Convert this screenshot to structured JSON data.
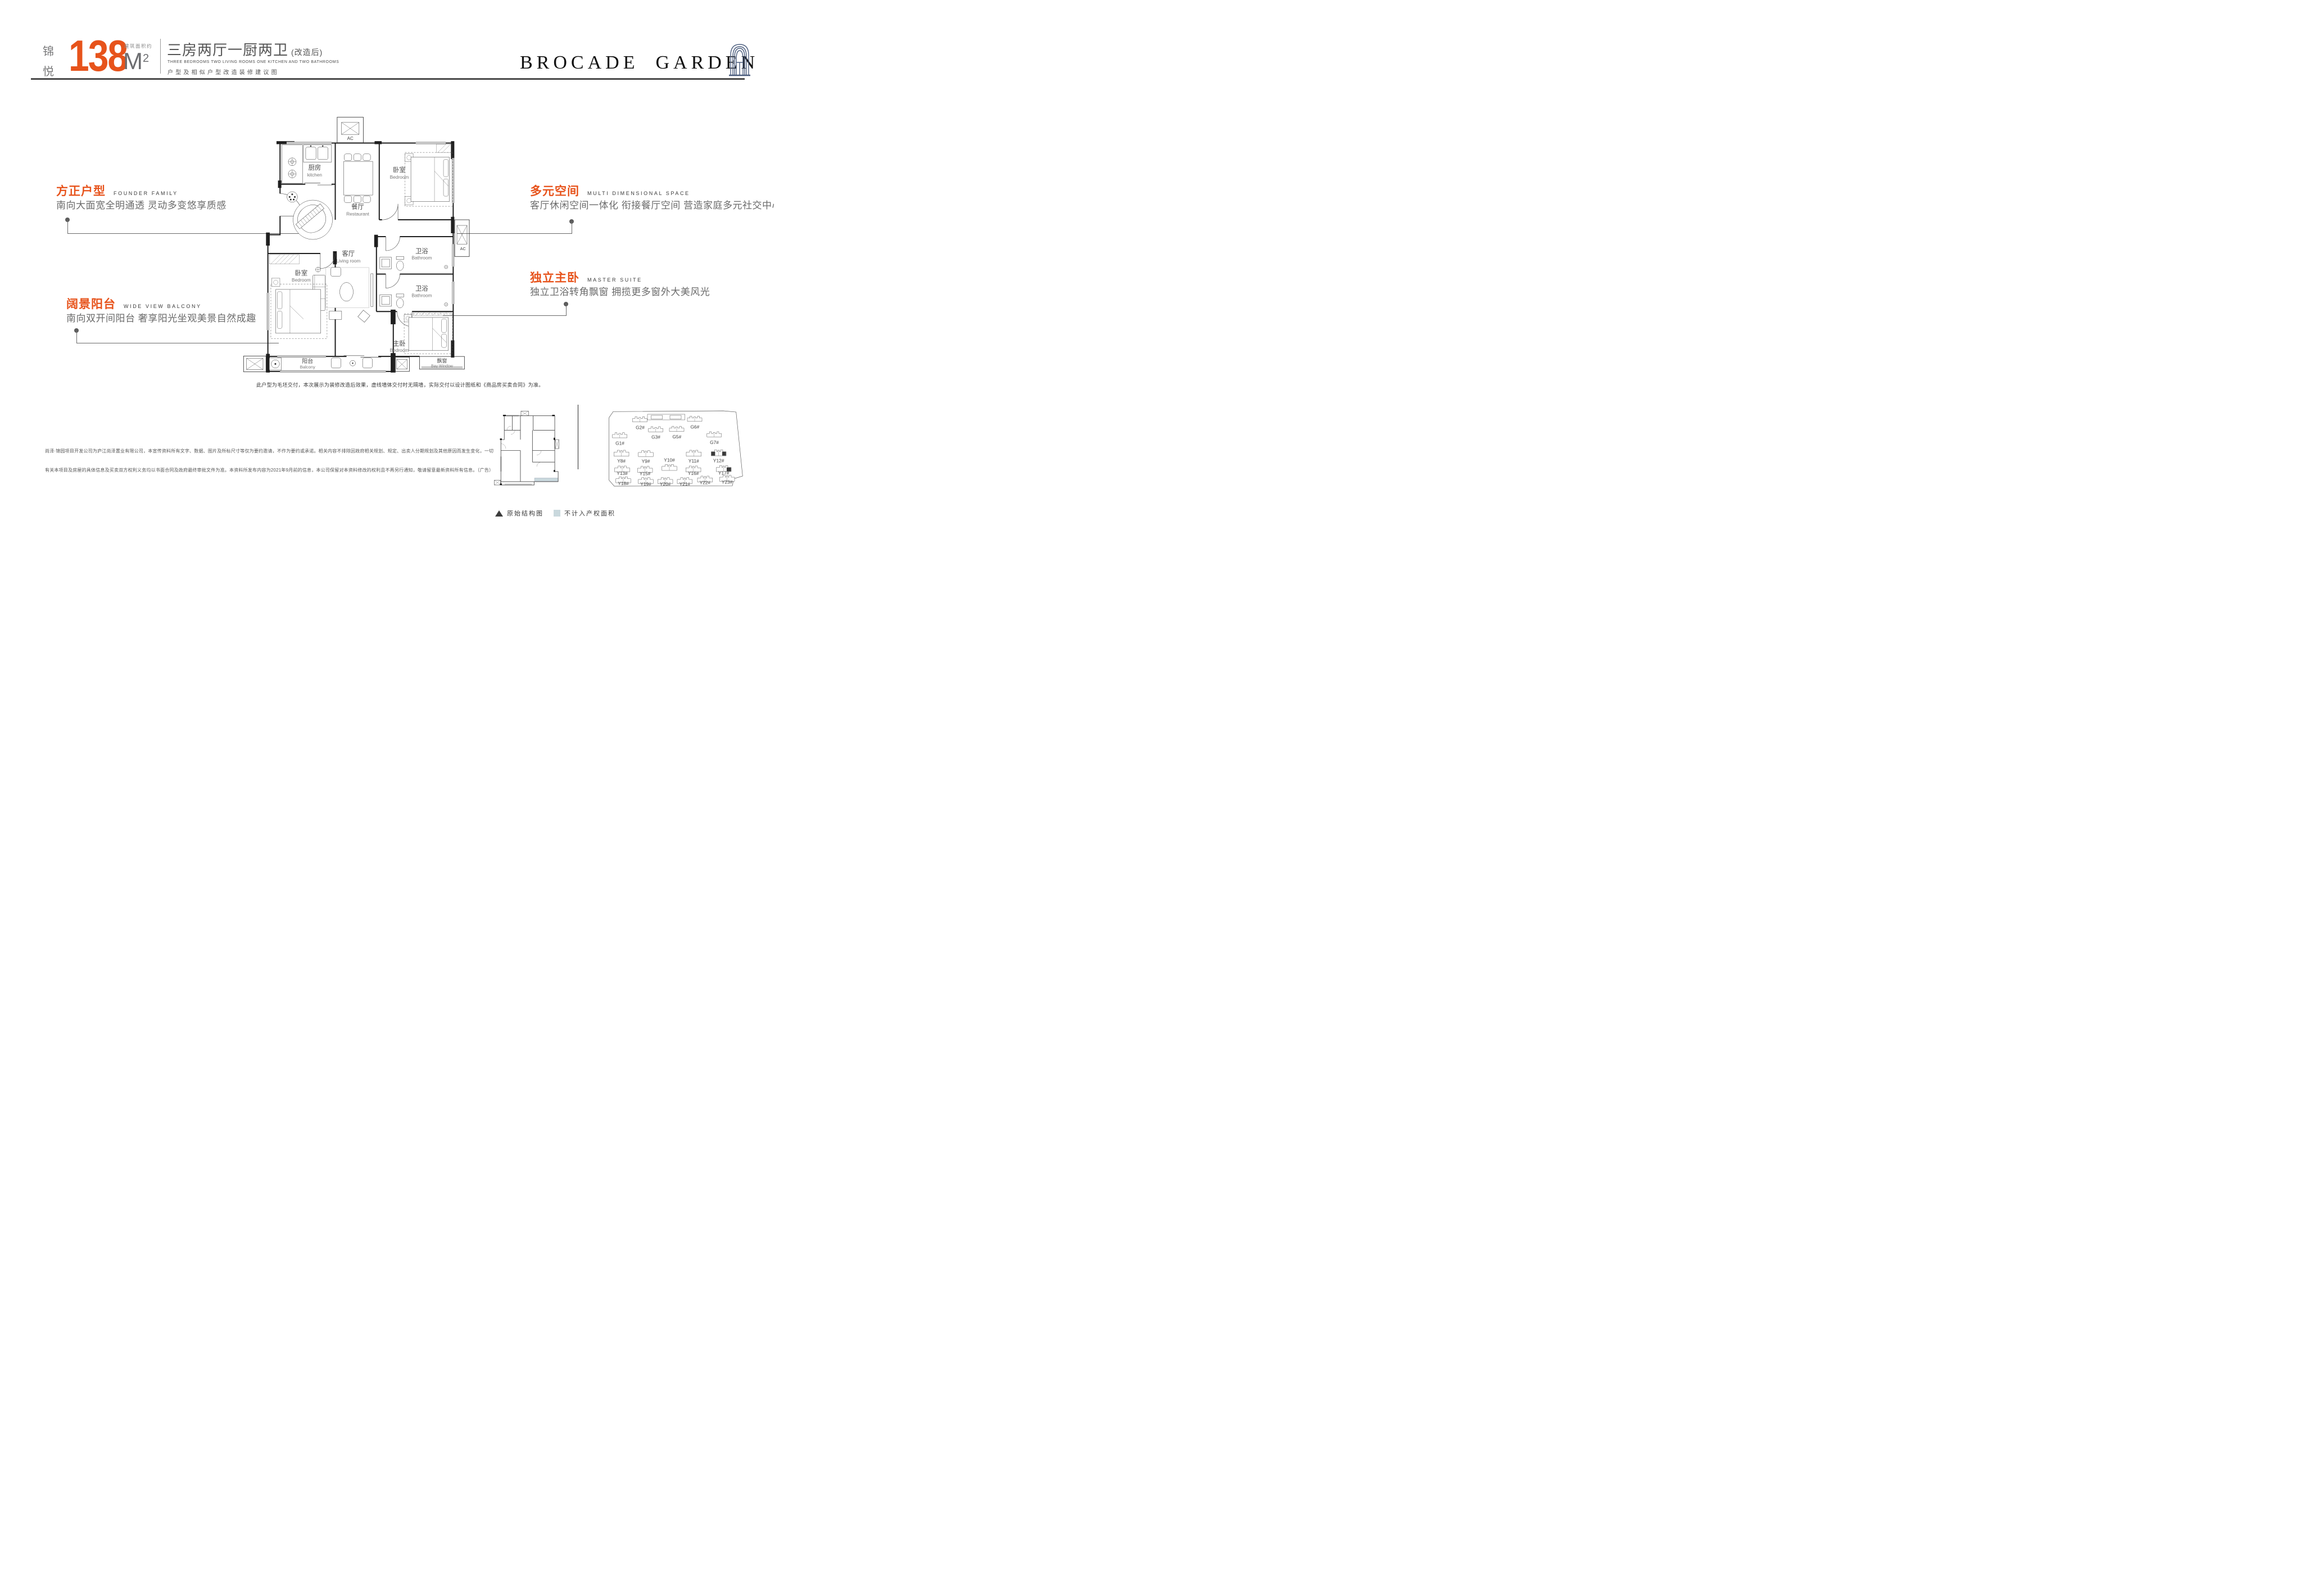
{
  "header": {
    "brand_char1": "锦",
    "brand_char2": "悦",
    "area_label": "建筑面积约",
    "area_value": "138",
    "area_unit": "M",
    "area_sup": "2",
    "title_cn": "三房两厅一厨两卫",
    "title_suffix": "(改造后)",
    "title_en": "THREE BEDROOMS  TWO LIVING ROOMS ONE KITCHEN AND TWO BATHROOMS",
    "title_note": "户型及相似户型改造装修建议图",
    "logo_word1": "BROCADE",
    "logo_word2": "GARDEN"
  },
  "callouts": {
    "founder": {
      "title": "方正户型",
      "en": "FOUNDER FAMILY",
      "desc": "南向大面宽全明通透 灵动多变悠享质感"
    },
    "multi": {
      "title": "多元空间",
      "en": "MULTI DIMENSIONAL SPACE",
      "desc": "客厅休闲空间一体化 衔接餐厅空间 营造家庭多元社交中心"
    },
    "balcony": {
      "title": "阔景阳台",
      "en": "WIDE VIEW BALCONY",
      "desc": "南向双开间阳台 奢享阳光坐观美景自然成趣"
    },
    "master": {
      "title": "独立主卧",
      "en": "MASTER SUITE",
      "desc": "独立卫浴转角飘窗 拥揽更多窗外大美风光"
    }
  },
  "floorplan": {
    "ac_label": "AC",
    "rooms": {
      "kitchen": {
        "cn": "厨房",
        "en": "kitchen"
      },
      "dining": {
        "cn": "餐厅",
        "en": "Restaurant"
      },
      "bedroom_top": {
        "cn": "卧室",
        "en": "Bedroom"
      },
      "bathroom_upper": {
        "cn": "卫浴",
        "en": "Bathroom"
      },
      "bathroom_lower": {
        "cn": "卫浴",
        "en": "Bathroom"
      },
      "living": {
        "cn": "客厅",
        "en": "Living room"
      },
      "bedroom_left": {
        "cn": "卧室",
        "en": "Bedroom"
      },
      "master": {
        "cn": "主卧",
        "en": "Bedroom"
      },
      "bay_window": {
        "cn": "飘窗",
        "en": "Bay Window"
      },
      "balcony": {
        "cn": "阳台",
        "en": "Balcony"
      }
    }
  },
  "notes": {
    "plan_note": "此户型为毛坯交付，本次展示为装修改造后效果，虚线墙体交付时无隔墙，实际交付以设计图纸和《商品房买卖合同》为准。",
    "disclaimer_line1": "尚泽·锦园项目开发公司为庐江尚泽置业有限公司，本宣传资料所有文字、数据、图片及所标尺寸等仅为要约邀请，不作为要约或承诺。相关内容不排除因政府相关规划、规定、出卖人分期规划及其他原因而发生变化，一切",
    "disclaimer_line2": "有关本项目及房屋的具体信息及买卖双方权利义务均以书面合同及政府最终审批文件为准。本资料所发布内容为2021年9月前的信息，本公司保留对本资料修改的权利且不再另行通知，敬请留意最新资料所有信息。（广告）"
  },
  "site_plan": {
    "buildings": [
      "G1#",
      "G2#",
      "G3#",
      "G5#",
      "G6#",
      "G7#",
      "Y8#",
      "Y9#",
      "Y10#",
      "Y11#",
      "Y12#",
      "Y13#",
      "Y15#",
      "Y16#",
      "Y17#",
      "Y18#",
      "Y19#",
      "Y20#",
      "Y21#",
      "Y22#",
      "Y23#"
    ],
    "highlighted": "Y12#"
  },
  "legend": {
    "original_structure": "原始结构图",
    "excluded_area": "不计入产权面积"
  },
  "colors": {
    "accent": "#e7531b",
    "excluded_fill": "#c9d8dd",
    "arch_icon": "#4a5c7d"
  }
}
